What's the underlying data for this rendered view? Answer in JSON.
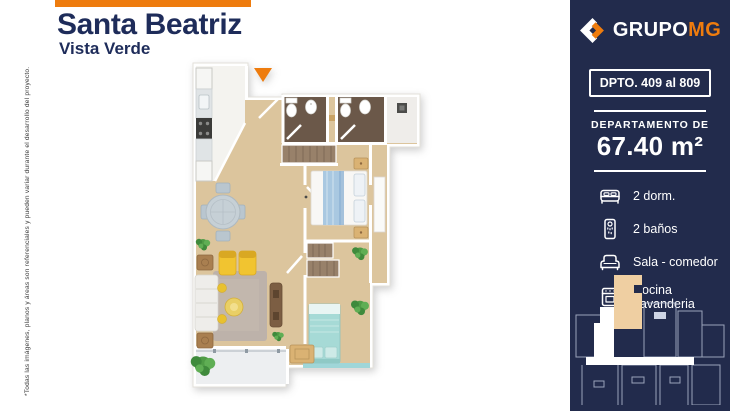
{
  "header": {
    "title": "Santa Beatriz",
    "subtitle": "Vista Verde"
  },
  "disclaimer": "*Todas las imágenes, planos y áreas son referenciales y pueden variar durante el desarrollo del proyecto.",
  "sidebar": {
    "brand": {
      "name_primary": "GRUPO",
      "name_accent": "MG"
    },
    "unit_badge": "DPTO. 409 al 809",
    "area": {
      "label": "DEPARTAMENTO DE",
      "value": "67.40 m²"
    },
    "features": [
      {
        "icon": "bed-icon",
        "label": "2 dorm."
      },
      {
        "icon": "shower-icon",
        "label": "2 baños"
      },
      {
        "icon": "sofa-icon",
        "label": "Sala - comedor"
      },
      {
        "icon": "kitchen-icon",
        "label": "Cocina Lavanderia"
      }
    ]
  },
  "colors": {
    "sidebar_navy": "#222b4c",
    "accent_orange": "#ee7c0e",
    "title_navy": "#1e2c5a",
    "wood_floor": "#dcc59d",
    "bathroom_floor": "#6b5849",
    "teal_bed": "#a6dad6"
  }
}
